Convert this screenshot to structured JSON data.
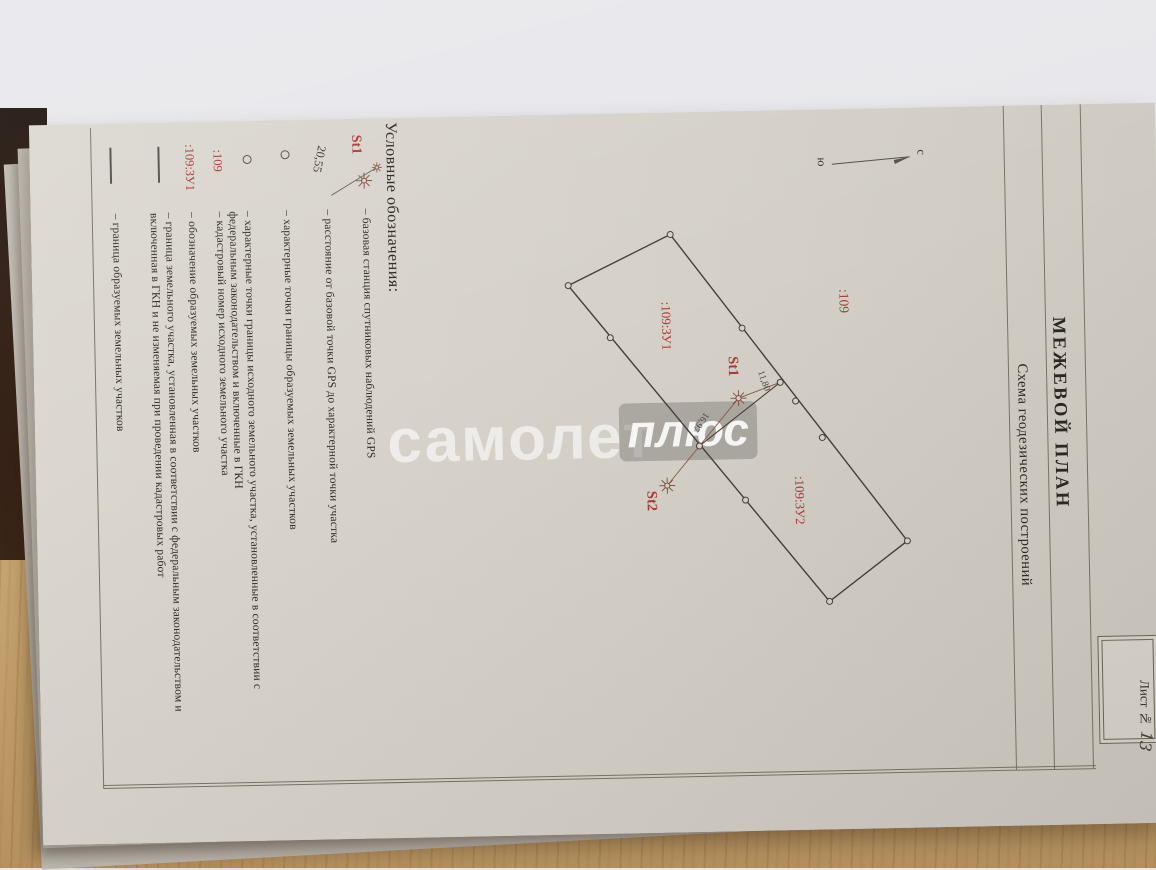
{
  "document": {
    "title": "МЕЖЕВОЙ ПЛАН",
    "subtitle": "Схема геодезических построений",
    "sheet": {
      "label": "Лист №",
      "number": "13"
    }
  },
  "compass": {
    "north_label": "с",
    "south_label": "ю"
  },
  "watermark": {
    "word1": "самолет",
    "word2": "плюс"
  },
  "colors": {
    "accent_red": "#a93c38",
    "ink": "#322d26"
  },
  "legend": {
    "header": "Условные обозначения:",
    "rows": [
      {
        "label": "St1",
        "symbol": "gps-station-star",
        "text": "– базовая станция спутниковых наблюдений GPS"
      },
      {
        "label": "20,55",
        "symbol": "distance-line",
        "text": "– расстояние от базовой точки GPS до характерной точки участка"
      },
      {
        "label": "",
        "symbol": "point-circle",
        "text": "– характерные точки границы образуемых земельных участков"
      },
      {
        "label": "",
        "symbol": "point-circle",
        "text": "– характерные точки границы исходного земельного участка, установленные в соответствии с федеральным законодательством и включенные в ГКН"
      },
      {
        "label": ":109",
        "symbol": "none",
        "text": "– кадастровый номер исходного земельного участка"
      },
      {
        "label": ":109:ЗУ1",
        "symbol": "none",
        "text": "– обозначение образуемых земельных участков"
      },
      {
        "label": "",
        "symbol": "boundary-line",
        "text": "– граница земельного участка, установленная в соответствии с федеральным законодательством и включенная в ГКН и не изменяемая при проведении кадастровых работ"
      },
      {
        "label": "",
        "symbol": "boundary-line",
        "text": "– граница образуемых земельных участков"
      }
    ]
  },
  "map": {
    "labels": {
      "parent_parcel": ":109",
      "parcel_zu1": ":109:ЗУ1",
      "parcel_zu2": ":109:ЗУ2"
    },
    "stations": {
      "st1": "St1",
      "st2": "St2"
    },
    "distances": {
      "st1_to_point": "11,80",
      "st1_to_st2": "16,97"
    }
  }
}
